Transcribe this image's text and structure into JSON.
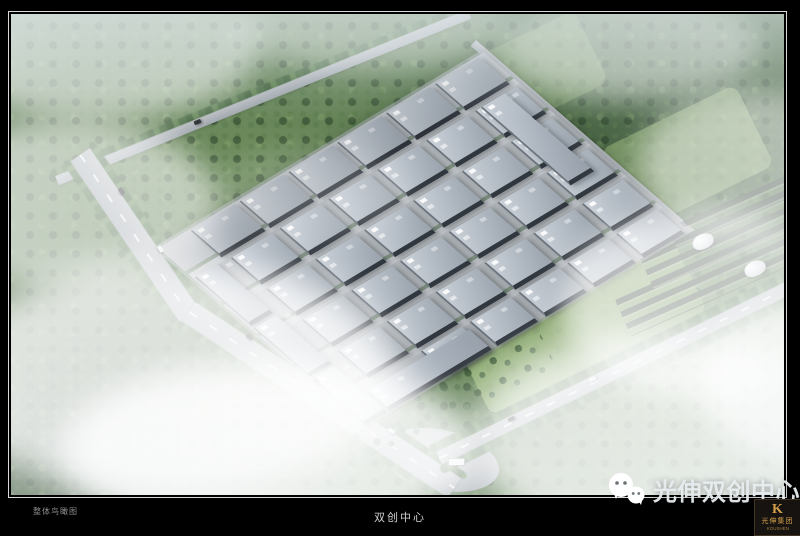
{
  "titleblock": {
    "label_left": "整体鸟瞰图",
    "label_center": "双创中心"
  },
  "watermark": {
    "icon": "wechat-icon",
    "text": "光伸双创中心"
  },
  "logo": {
    "letter": "K",
    "company": "光伸集团",
    "latin": "KOUSHEN"
  },
  "palette": {
    "frame_line": "#d9d9d9",
    "forest_base": "#5d7b52",
    "meadow": "#9ab77c",
    "road": "#a8aeb3",
    "roof_light": "#c9cfd7",
    "roof_mid": "#a2abb5",
    "facade_dark": "#31373f",
    "tree_line": "#44663e",
    "mist": "#ffffff",
    "watermark_text": "#e8edf0",
    "logo_gold": "#d2a04c"
  },
  "scene": {
    "park": {
      "grids": [
        {
          "name": "warehouse-back-row",
          "cls": "back",
          "x0": 36,
          "y0": 2,
          "cols": 6,
          "rows": 1,
          "dx": 57,
          "dy": 0,
          "w": 50,
          "h": 34
        },
        {
          "name": "warehouse-building",
          "cls": "",
          "x0": 42,
          "y0": 46,
          "cols": 6,
          "rows": 4,
          "dx": 57,
          "dy": 45,
          "w": 46,
          "h": 34
        },
        {
          "name": "warehouse-building",
          "cls": "",
          "x0": 99,
          "y0": 224,
          "cols": 5,
          "rows": 1,
          "dx": 57,
          "dy": 0,
          "w": 46,
          "h": 30
        }
      ],
      "long_blocks": [
        {
          "x": 2,
          "y": 44,
          "w": 24,
          "h": 66
        },
        {
          "x": 2,
          "y": 118,
          "w": 24,
          "h": 66
        },
        {
          "x": 2,
          "y": 192,
          "w": 24,
          "h": 62
        },
        {
          "x": 30,
          "y": 230,
          "w": 118,
          "h": 24
        },
        {
          "x": 334,
          "y": 46,
          "w": 26,
          "h": 108
        }
      ]
    },
    "cars": [
      {
        "x": 118,
        "y": 189,
        "r": 56,
        "c": "#20242a"
      },
      {
        "x": 157,
        "y": 247,
        "r": 56,
        "c": "#e8eaec"
      },
      {
        "x": 246,
        "y": 335,
        "r": 34,
        "c": "#20242a"
      },
      {
        "x": 313,
        "y": 379,
        "r": 34,
        "c": "#3a4148"
      },
      {
        "x": 388,
        "y": 429,
        "r": 34,
        "c": "#e8eaec"
      },
      {
        "x": 508,
        "y": 417,
        "r": -26,
        "c": "#20242a"
      },
      {
        "x": 589,
        "y": 377,
        "r": -26,
        "c": "#e8eaec"
      },
      {
        "x": 194,
        "y": 120,
        "r": -22,
        "c": "#20242a"
      }
    ],
    "domes": [
      {
        "x": 692,
        "y": 234
      },
      {
        "x": 744,
        "y": 261
      }
    ]
  }
}
